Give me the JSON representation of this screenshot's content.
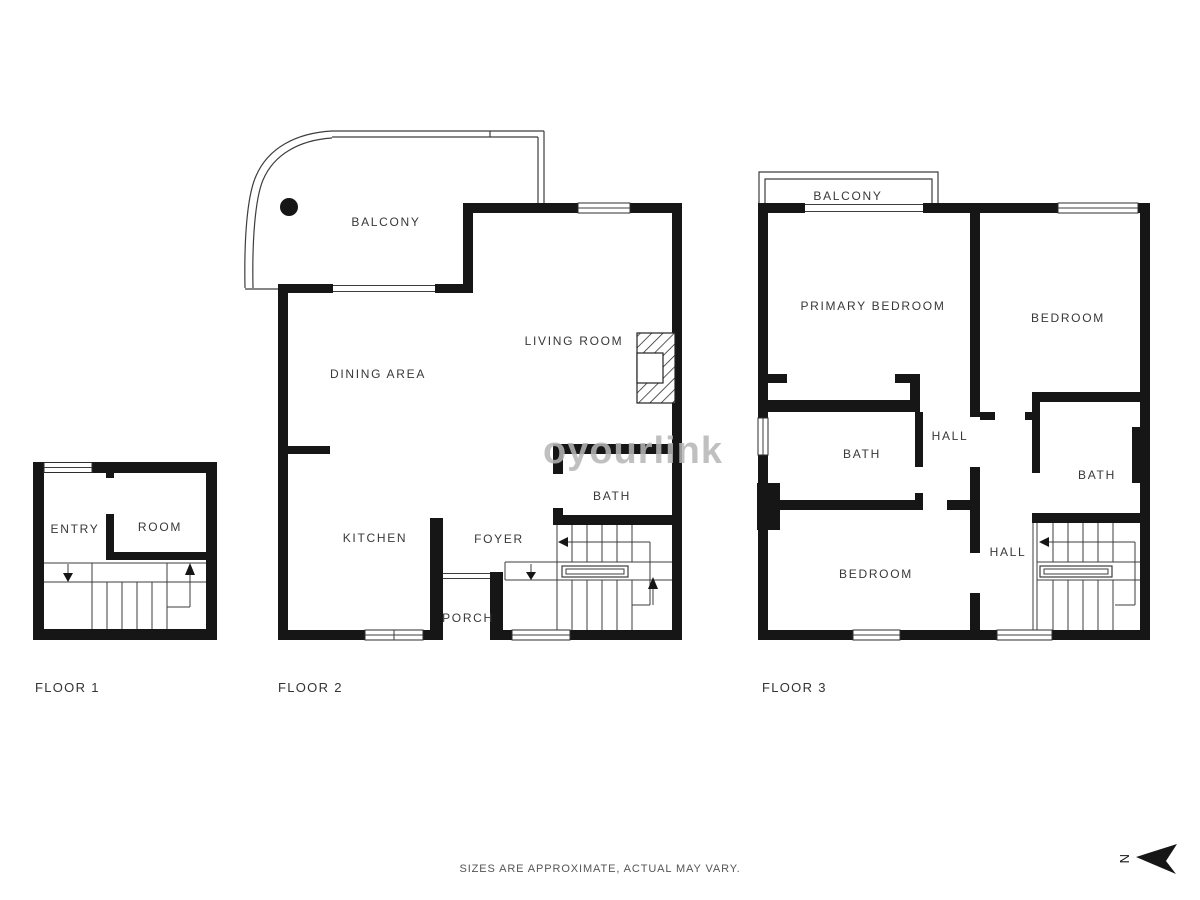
{
  "floors": [
    {
      "label": "FLOOR 1",
      "rooms": {
        "entry": "ENTRY",
        "room": "ROOM"
      }
    },
    {
      "label": "FLOOR 2",
      "rooms": {
        "balcony": "BALCONY",
        "dining": "DINING AREA",
        "living": "LIVING ROOM",
        "kitchen": "KITCHEN",
        "foyer": "FOYER",
        "porch": "PORCH",
        "bath": "BATH"
      }
    },
    {
      "label": "FLOOR 3",
      "rooms": {
        "balcony": "BALCONY",
        "primary_bedroom": "PRIMARY BEDROOM",
        "bedroom": "BEDROOM",
        "bath_left": "BATH",
        "hall_upper": "HALL",
        "bath_right": "BATH",
        "hall_lower": "HALL",
        "bedroom_lower": "BEDROOM"
      }
    }
  ],
  "footer": {
    "disclaimer": "SIZES ARE APPROXIMATE, ACTUAL MAY VARY."
  },
  "compass": {
    "north_label": "N"
  },
  "watermark": {
    "text": "oyourlink"
  },
  "colors": {
    "wall": "#161616",
    "line": "#3d3d3d",
    "label": "#383838",
    "watermark": "#b6b6b6",
    "background": "#ffffff"
  }
}
